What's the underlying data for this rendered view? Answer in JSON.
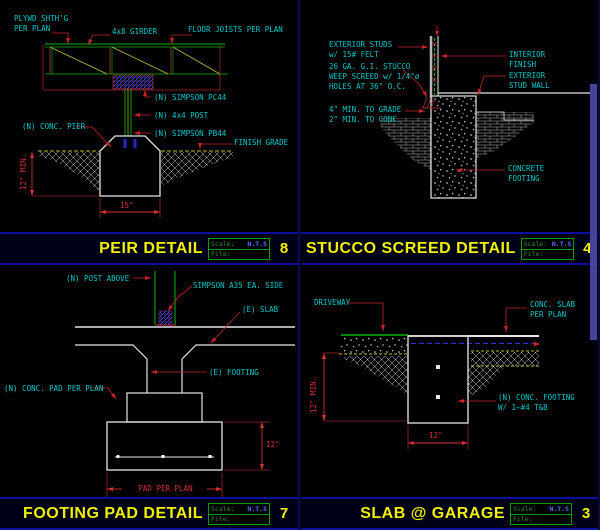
{
  "palette": {
    "cyan": "#00c8c8",
    "red": "#d43030",
    "yellow": "#f0f000",
    "green": "#00b400",
    "white": "#e6e6e6",
    "navy": "#0d0d9e",
    "blue": "#2e2ed0"
  },
  "titlebar": {
    "scale_label": "Scale:",
    "scale_value": "N.T.S",
    "file_label": "File:"
  },
  "quadrants": {
    "peir": {
      "title": "PEIR DETAIL",
      "number": "8",
      "labels": {
        "plywd": "PLYWD SHTH'G\nPER PLAN",
        "girder": "4x8 GIRDER",
        "joists": "FLOOR JOISTS PER PLAN",
        "pc44": "(N) SIMPSON PC44",
        "post": "(N) 4x4 POST",
        "pb44": "(N) SIMPSON PB44",
        "pier": "(N) CONC. PIER",
        "grade": "FINISH GRADE",
        "dim_depth": "12\" MIN.",
        "dim_width": "15\""
      }
    },
    "stucco": {
      "title": "STUCCO SCREED DETAIL",
      "number": "4",
      "labels": {
        "studs": "EXTERIOR STUDS\nw/ 15# FELT",
        "screed": "26 GA. G.I. STUCCO\nWEEP SCREED w/ 1/4\"ø\nHOLES AT 36\" O.C.",
        "interior": "INTERIOR\nFINISH",
        "exterior": "EXTERIOR\nSTUD WALL",
        "mins": "4\" MIN. TO GRADE\n2\" MIN. TO CONC.",
        "footing": "CONCRETE\nFOOTING"
      }
    },
    "footing_pad": {
      "title": "FOOTING PAD DETAIL",
      "number": "7",
      "labels": {
        "post_above": "(N) POST ABOVE",
        "a35": "SIMPSON A35 EA. SIDE",
        "slab": "(E) SLAB",
        "footing": "(E) FOOTING",
        "pad": "(N) CONC. PAD PER PLAN",
        "dim_height": "12\"",
        "dim_pad": "PAD PER PLAN"
      }
    },
    "slab_garage": {
      "title": "SLAB @ GARAGE",
      "number": "3",
      "labels": {
        "driveway": "DRIVEWAY",
        "slab": "CONC. SLAB\nPER PLAN",
        "footing": "(N) CONC. FOOTING\nW/ 1—#4 T&B",
        "dim_depth": "12\" MIN.",
        "dim_width": "12\""
      }
    }
  }
}
